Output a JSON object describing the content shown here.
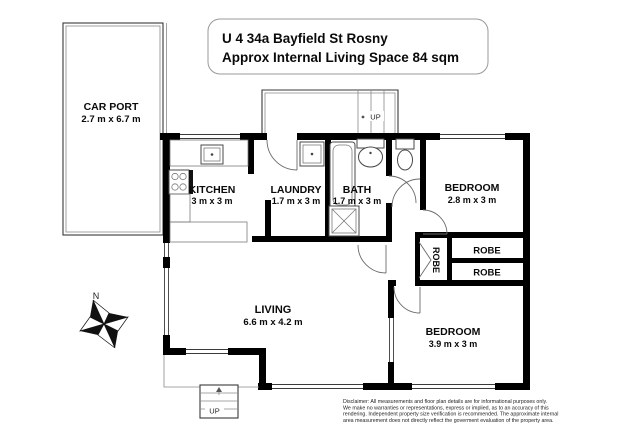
{
  "title": {
    "line1": "U 4 34a  Bayfield St Rosny",
    "line2": "Approx Internal Living Space 84 sqm"
  },
  "rooms": {
    "carport": {
      "name": "CAR PORT",
      "dims": "2.7 m x 6.7 m"
    },
    "kitchen": {
      "name": "KITCHEN",
      "dims": "3 m x 3 m"
    },
    "laundry": {
      "name": "LAUNDRY",
      "dims": "1.7 m x 3 m"
    },
    "bath": {
      "name": "BATH",
      "dims": "1.7 m x 3 m"
    },
    "bedroom1": {
      "name": "BEDROOM",
      "dims": "2.8 m x 3 m"
    },
    "bedroom2": {
      "name": "BEDROOM",
      "dims": "3.9 m x 3 m"
    },
    "living": {
      "name": "LIVING",
      "dims": "6.6 m x 4.2 m"
    },
    "robe1": {
      "name": "ROBE"
    },
    "robe2": {
      "name": "ROBE"
    },
    "robe3": {
      "name": "ROBE"
    }
  },
  "stairs": {
    "top_label": "UP",
    "bottom_label": "UP"
  },
  "compass": {
    "north_label": "N"
  },
  "disclaimer": {
    "line1": "Disclaimer: All measurements and floor plan details are for informational purposes only.",
    "line2": "We make no warranties or representations, express or implied, as to an accuracy of this",
    "line3": "rendering. Independent property size verification is recommended. The approximate internal",
    "line4": "area measurement does not directly reflect the goverment evaluation of the property area."
  },
  "colors": {
    "wall": "#000000",
    "thin_line": "#3a3a3a",
    "background": "#ffffff"
  }
}
